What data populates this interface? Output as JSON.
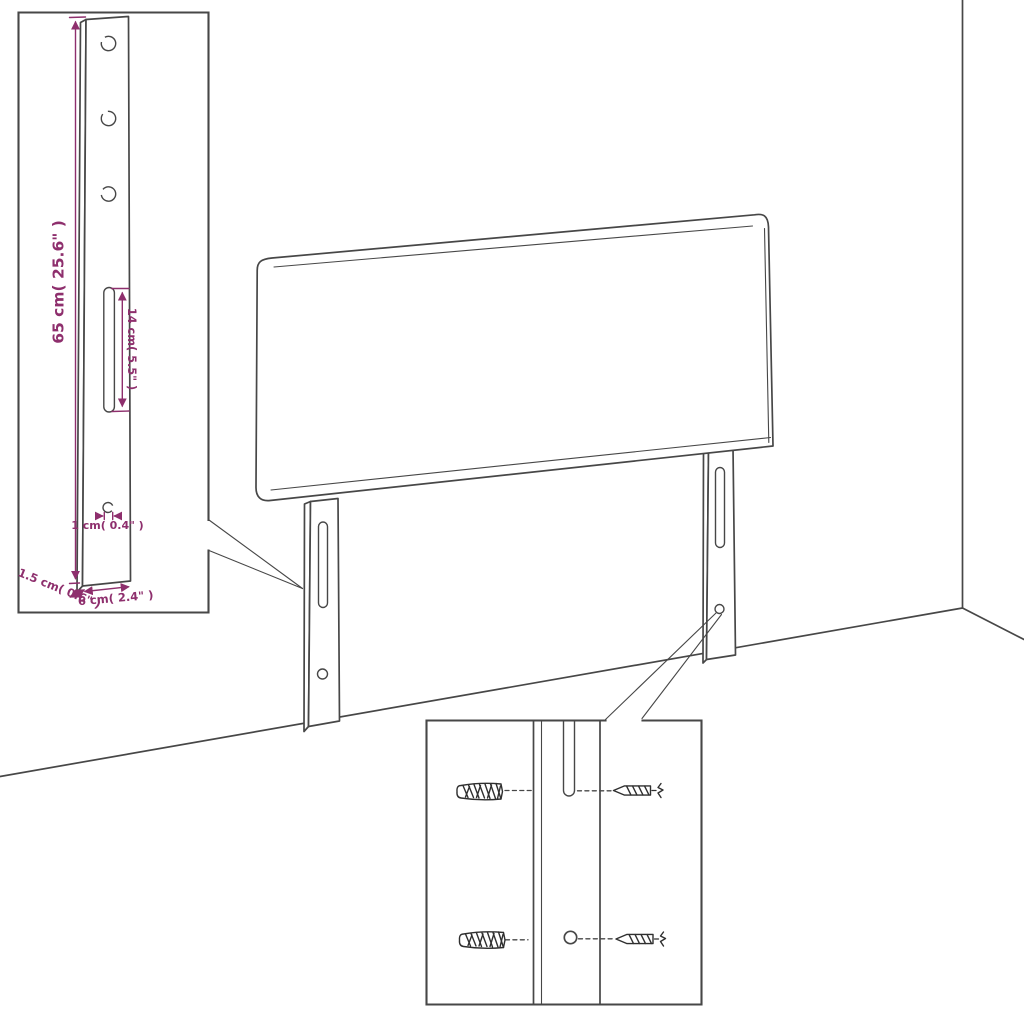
{
  "colors": {
    "line": "#474747",
    "detail": "#2f2f2f",
    "dimension": "#8e2f6d",
    "background": "#ffffff"
  },
  "dimension_labels": {
    "leg_height": "65 cm( 25.6\" )",
    "slot_length": "14 cm( 5.5\" )",
    "hole_diameter": "1 cm( 0.4\" )",
    "leg_thickness": "1.5 cm( 0.6\" )",
    "leg_width": "6 cm( 2.4\" )"
  }
}
